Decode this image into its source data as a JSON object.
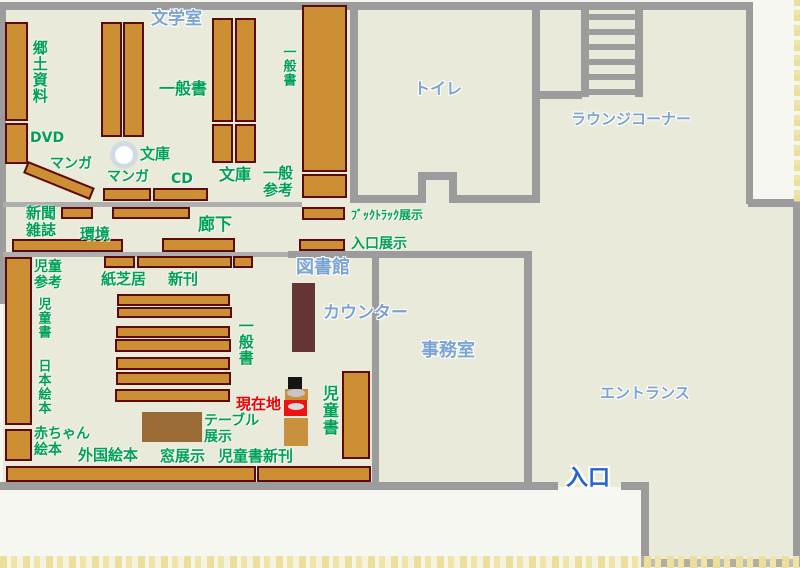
{
  "meta": {
    "kind": "library-floor-plan",
    "width": 800,
    "height": 568
  },
  "colors": {
    "beige": "#eaeadb",
    "wall": "#9c9c9c",
    "wall_light": "#aeaeae",
    "shelf": "#cc8f33",
    "shelf_border": "#5d0a0a",
    "green": "#00a156",
    "blue": "#7ba3d4",
    "entrance_blue": "#2263cc",
    "red": "#ee0000",
    "counter": "#653434",
    "table": "#9a6b35",
    "marker_tan": "#c8913f",
    "marker_red": "#ee1111",
    "marker_black": "#141414"
  },
  "areas": [
    {
      "name": "floor-main",
      "x": 3,
      "y": 3,
      "w": 747,
      "h": 484
    },
    {
      "name": "floor-right-strip",
      "x": 749,
      "y": 204,
      "w": 48,
      "h": 283
    },
    {
      "name": "floor-entrance-vestibule",
      "x": 645,
      "y": 487,
      "w": 152,
      "h": 77
    }
  ],
  "walls": [
    {
      "name": "wall-top",
      "x": 1,
      "y": 2,
      "w": 752,
      "h": 8
    },
    {
      "name": "wall-left",
      "x": 0,
      "y": 2,
      "w": 6,
      "h": 302
    },
    {
      "name": "wall-right-upper",
      "x": 746,
      "y": 2,
      "w": 7,
      "h": 202
    },
    {
      "name": "wall-notch-step",
      "x": 748,
      "y": 199,
      "w": 52,
      "h": 8
    },
    {
      "name": "wall-right-lower",
      "x": 793,
      "y": 204,
      "w": 7,
      "h": 362
    },
    {
      "name": "wall-bottom-right",
      "x": 648,
      "y": 559,
      "w": 152,
      "h": 8
    },
    {
      "name": "wall-vestibule-left",
      "x": 641,
      "y": 483,
      "w": 8,
      "h": 84
    },
    {
      "name": "wall-bottom-gap-right",
      "x": 621,
      "y": 482,
      "w": 28,
      "h": 8
    },
    {
      "name": "wall-bottom-main",
      "x": 0,
      "y": 482,
      "w": 558,
      "h": 8
    },
    {
      "name": "wall-toilet-left",
      "x": 350,
      "y": 2,
      "w": 8,
      "h": 201
    },
    {
      "name": "wall-toilet-right",
      "x": 532,
      "y": 2,
      "w": 8,
      "h": 201
    },
    {
      "name": "wall-toilet-bottom-left",
      "x": 350,
      "y": 195,
      "w": 68,
      "h": 8
    },
    {
      "name": "wall-toilet-bottom-right",
      "x": 457,
      "y": 195,
      "w": 83,
      "h": 8
    },
    {
      "name": "wall-toilet-alcove-left",
      "x": 418,
      "y": 172,
      "w": 8,
      "h": 31
    },
    {
      "name": "wall-toilet-alcove-right",
      "x": 449,
      "y": 172,
      "w": 8,
      "h": 31
    },
    {
      "name": "wall-toilet-alcove-top",
      "x": 418,
      "y": 172,
      "w": 39,
      "h": 8
    },
    {
      "name": "wall-lounge-step",
      "x": 536,
      "y": 91,
      "w": 46,
      "h": 8
    },
    {
      "name": "wall-corridor-upper",
      "x": 3,
      "y": 202,
      "w": 299,
      "h": 5,
      "light": true
    },
    {
      "name": "wall-corridor-lower",
      "x": 3,
      "y": 252,
      "w": 285,
      "h": 5,
      "light": true
    },
    {
      "name": "wall-office-top",
      "x": 288,
      "y": 251,
      "w": 244,
      "h": 7
    },
    {
      "name": "wall-office-left",
      "x": 372,
      "y": 251,
      "w": 7,
      "h": 232
    },
    {
      "name": "wall-office-right",
      "x": 524,
      "y": 251,
      "w": 8,
      "h": 232
    }
  ],
  "stairs": {
    "name": "stairs",
    "x": 581,
    "y": 2,
    "w": 62,
    "h": 95,
    "rail_w": 8,
    "rungs": [
      12,
      27,
      42,
      57,
      72,
      87
    ],
    "rung_h": 6
  },
  "pillar": {
    "name": "pillar-column",
    "x": 113,
    "y": 144,
    "d": 22
  },
  "shelves": [
    {
      "x": 5,
      "y": 22,
      "w": 23,
      "h": 99
    },
    {
      "x": 5,
      "y": 123,
      "w": 23,
      "h": 41
    },
    {
      "x": 101,
      "y": 22,
      "w": 21,
      "h": 115
    },
    {
      "x": 123,
      "y": 22,
      "w": 21,
      "h": 115
    },
    {
      "x": 212,
      "y": 18,
      "w": 21,
      "h": 104
    },
    {
      "x": 235,
      "y": 18,
      "w": 21,
      "h": 104
    },
    {
      "x": 212,
      "y": 124,
      "w": 21,
      "h": 39
    },
    {
      "x": 235,
      "y": 124,
      "w": 21,
      "h": 39
    },
    {
      "x": 28,
      "y": 161,
      "w": 72,
      "h": 13,
      "rot": 22
    },
    {
      "x": 103,
      "y": 188,
      "w": 48,
      "h": 13
    },
    {
      "x": 153,
      "y": 188,
      "w": 55,
      "h": 13
    },
    {
      "x": 302,
      "y": 5,
      "w": 45,
      "h": 167
    },
    {
      "x": 302,
      "y": 174,
      "w": 45,
      "h": 24
    },
    {
      "x": 302,
      "y": 207,
      "w": 43,
      "h": 13
    },
    {
      "x": 299,
      "y": 239,
      "w": 46,
      "h": 12
    },
    {
      "x": 61,
      "y": 207,
      "w": 32,
      "h": 12
    },
    {
      "x": 112,
      "y": 207,
      "w": 78,
      "h": 12
    },
    {
      "x": 12,
      "y": 239,
      "w": 111,
      "h": 13
    },
    {
      "x": 162,
      "y": 238,
      "w": 73,
      "h": 14
    },
    {
      "x": 104,
      "y": 256,
      "w": 31,
      "h": 12
    },
    {
      "x": 137,
      "y": 256,
      "w": 95,
      "h": 12
    },
    {
      "x": 233,
      "y": 256,
      "w": 20,
      "h": 12
    },
    {
      "x": 5,
      "y": 257,
      "w": 27,
      "h": 168
    },
    {
      "x": 5,
      "y": 429,
      "w": 27,
      "h": 32
    },
    {
      "x": 117,
      "y": 294,
      "w": 113,
      "h": 12
    },
    {
      "x": 117,
      "y": 307,
      "w": 115,
      "h": 11
    },
    {
      "x": 116,
      "y": 326,
      "w": 114,
      "h": 12
    },
    {
      "x": 115,
      "y": 339,
      "w": 116,
      "h": 13
    },
    {
      "x": 116,
      "y": 357,
      "w": 114,
      "h": 13
    },
    {
      "x": 116,
      "y": 372,
      "w": 115,
      "h": 13
    },
    {
      "x": 115,
      "y": 389,
      "w": 115,
      "h": 13
    },
    {
      "x": 342,
      "y": 371,
      "w": 28,
      "h": 88
    },
    {
      "x": 6,
      "y": 466,
      "w": 250,
      "h": 16
    },
    {
      "x": 257,
      "y": 466,
      "w": 114,
      "h": 16
    }
  ],
  "furniture": [
    {
      "name": "counter-desk",
      "x": 292,
      "y": 283,
      "w": 23,
      "h": 69,
      "color": "#653434"
    },
    {
      "name": "display-table",
      "x": 142,
      "y": 412,
      "w": 60,
      "h": 30,
      "color": "#9a6b35"
    }
  ],
  "marker_parts": [
    {
      "name": "marker-head",
      "x": 288,
      "y": 377,
      "w": 14,
      "h": 13,
      "color": "#141414"
    },
    {
      "name": "marker-shoulders",
      "x": 285,
      "y": 389,
      "w": 23,
      "h": 11,
      "color": "#c8913f"
    },
    {
      "name": "marker-shoulder-ellipse",
      "x": 287,
      "y": 389,
      "w": 18,
      "h": 8,
      "color": "#c6c6c6",
      "ellipse": true
    },
    {
      "name": "marker-red-sign",
      "x": 284,
      "y": 400,
      "w": 23,
      "h": 16,
      "color": "#ee1111"
    },
    {
      "name": "marker-sign-ellipse",
      "x": 288,
      "y": 403,
      "w": 16,
      "h": 7,
      "color": "#d8d8d8",
      "ellipse": true
    },
    {
      "name": "marker-body",
      "x": 284,
      "y": 418,
      "w": 24,
      "h": 28,
      "color": "#c8913f"
    }
  ],
  "labels": [
    {
      "name": "label-literature-room",
      "text": "文学室",
      "x": 151,
      "y": 10,
      "size": 17,
      "kind": "blue"
    },
    {
      "name": "label-local-materials",
      "text": "郷土資料",
      "x": 31,
      "y": 40,
      "size": 15,
      "kind": "green",
      "vertical": true
    },
    {
      "name": "label-dvd",
      "text": "DVD",
      "x": 30,
      "y": 131,
      "size": 14,
      "kind": "green"
    },
    {
      "name": "label-manga-diagonal",
      "text": "マンガ",
      "x": 50,
      "y": 157,
      "size": 14,
      "kind": "green"
    },
    {
      "name": "label-general-books-top",
      "text": "一般書",
      "x": 159,
      "y": 80,
      "size": 16,
      "kind": "green"
    },
    {
      "name": "label-bunko-pillar",
      "text": "文庫",
      "x": 140,
      "y": 146,
      "size": 15,
      "kind": "green"
    },
    {
      "name": "label-manga-2",
      "text": "マンガ",
      "x": 107,
      "y": 170,
      "size": 14,
      "kind": "green"
    },
    {
      "name": "label-cd",
      "text": "CD",
      "x": 171,
      "y": 172,
      "size": 14,
      "kind": "green"
    },
    {
      "name": "label-bunko-right",
      "text": "文庫",
      "x": 219,
      "y": 166,
      "size": 16,
      "kind": "green"
    },
    {
      "name": "label-general-reference",
      "text": "一般\n参考",
      "x": 263,
      "y": 165,
      "size": 15,
      "kind": "green"
    },
    {
      "name": "label-general-books-wall",
      "text": "一般書",
      "x": 280,
      "y": 45,
      "size": 13,
      "kind": "green",
      "vertical": true
    },
    {
      "name": "label-toilet",
      "text": "トイレ",
      "x": 414,
      "y": 80,
      "size": 16,
      "kind": "blue"
    },
    {
      "name": "label-lounge-corner",
      "text": "ラウンジコーナー",
      "x": 571,
      "y": 111,
      "size": 15,
      "kind": "blue"
    },
    {
      "name": "label-newspapers-magazines",
      "text": "新聞\n雑誌",
      "x": 26,
      "y": 205,
      "size": 15,
      "kind": "green"
    },
    {
      "name": "label-environment",
      "text": "環境",
      "x": 80,
      "y": 226,
      "size": 15,
      "kind": "green"
    },
    {
      "name": "label-corridor",
      "text": "廊下",
      "x": 198,
      "y": 216,
      "size": 17,
      "kind": "green"
    },
    {
      "name": "label-booktruck-display",
      "text": "ﾌﾞｯｸﾄﾗｯｸ展示",
      "x": 351,
      "y": 209,
      "size": 12,
      "kind": "green"
    },
    {
      "name": "label-entrance-display",
      "text": "入口展示",
      "x": 351,
      "y": 237,
      "size": 14,
      "kind": "green"
    },
    {
      "name": "label-library",
      "text": "図書館",
      "x": 296,
      "y": 258,
      "size": 18,
      "kind": "blue"
    },
    {
      "name": "label-counter",
      "text": "カウンター",
      "x": 323,
      "y": 304,
      "size": 17,
      "kind": "blue"
    },
    {
      "name": "label-office",
      "text": "事務室",
      "x": 421,
      "y": 341,
      "size": 18,
      "kind": "blue"
    },
    {
      "name": "label-entrance-hall",
      "text": "エントランス",
      "x": 600,
      "y": 385,
      "size": 15,
      "kind": "blue"
    },
    {
      "name": "label-entrance-door",
      "text": "入口",
      "x": 566,
      "y": 467,
      "size": 22,
      "kind": "entrance"
    },
    {
      "name": "label-children-reference",
      "text": "児童\n参考",
      "x": 34,
      "y": 260,
      "size": 14,
      "kind": "green"
    },
    {
      "name": "label-children-books-left",
      "text": "児童書",
      "x": 35,
      "y": 297,
      "size": 13,
      "kind": "green",
      "vertical": true
    },
    {
      "name": "label-japanese-picture-books",
      "text": "日本絵本",
      "x": 35,
      "y": 359,
      "size": 13,
      "kind": "green",
      "vertical": true
    },
    {
      "name": "label-kamishibai",
      "text": "紙芝居",
      "x": 101,
      "y": 271,
      "size": 15,
      "kind": "green"
    },
    {
      "name": "label-new-books",
      "text": "新刊",
      "x": 168,
      "y": 271,
      "size": 15,
      "kind": "green"
    },
    {
      "name": "label-general-books-children",
      "text": "一般書",
      "x": 237,
      "y": 318,
      "size": 15,
      "kind": "green",
      "vertical": true
    },
    {
      "name": "label-current-location",
      "text": "現在地",
      "x": 236,
      "y": 396,
      "size": 15,
      "kind": "red"
    },
    {
      "name": "label-children-books-right",
      "text": "児童書",
      "x": 320,
      "y": 385,
      "size": 16,
      "kind": "green",
      "vertical": true
    },
    {
      "name": "label-table-display",
      "text": "テーブル\n展示",
      "x": 204,
      "y": 414,
      "size": 14,
      "kind": "green"
    },
    {
      "name": "label-baby-picture-books",
      "text": "赤ちゃん\n絵本",
      "x": 34,
      "y": 427,
      "size": 14,
      "kind": "green"
    },
    {
      "name": "label-foreign-picture-books",
      "text": "外国絵本",
      "x": 78,
      "y": 447,
      "size": 15,
      "kind": "green"
    },
    {
      "name": "label-window-display",
      "text": "窓展示",
      "x": 160,
      "y": 448,
      "size": 15,
      "kind": "green"
    },
    {
      "name": "label-children-new-books",
      "text": "児童書新刊",
      "x": 218,
      "y": 448,
      "size": 15,
      "kind": "green"
    }
  ]
}
